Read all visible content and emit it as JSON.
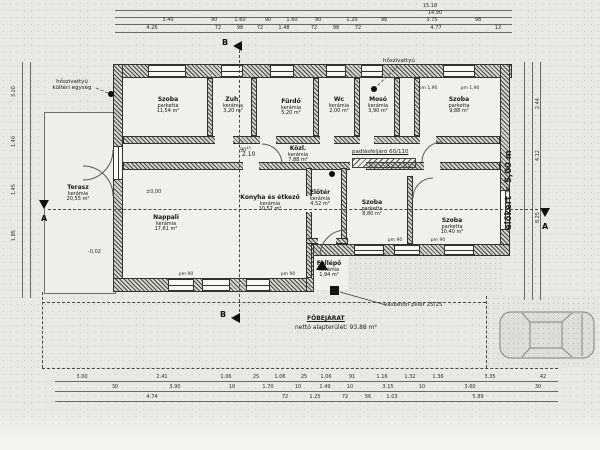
{
  "drawing": {
    "type": "floor-plan",
    "colors": {
      "paper": "#e9e8e4",
      "ink": "#34322e",
      "floor": "#f1f0ec"
    }
  },
  "labels": {
    "heat_pump_outdoor_1": "hőszivattyú",
    "heat_pump_outdoor_2": "kültéri egység",
    "heat_pump": "hőszivattyú",
    "attic_access": "padlásfeljáró 60/110",
    "door_width": "90",
    "door_width_sup": "45",
    "door_height": "2.10",
    "main_entrance": "FŐBEJÁRAT",
    "net_area": "nettó alapterület: 93,88 m²",
    "pillar": "vasbeton pillér 25/25",
    "front_yard": "előkert = 5,00 m",
    "level_zero": "±0,00",
    "level_terrace": "-0,02",
    "pm_190": "pm 1,90",
    "pm_90": "pm 90",
    "section_a": "A",
    "section_b": "B"
  },
  "rooms": [
    {
      "name": "Szoba",
      "material": "parketta",
      "area": "11,54 m²"
    },
    {
      "name": "Zuh.",
      "material": "kerámia",
      "area": "3,20 m²"
    },
    {
      "name": "Fürdő",
      "material": "kerámia",
      "area": "5,20 m²"
    },
    {
      "name": "Wc",
      "material": "kerámia",
      "area": "2,00 m²"
    },
    {
      "name": "Mosó",
      "material": "kerámia",
      "area": "3,90 m²"
    },
    {
      "name": "Szoba",
      "material": "parketta",
      "area": "9,88 m²"
    },
    {
      "name": "Terasz",
      "material": "kerámia",
      "area": "20,55 m²"
    },
    {
      "name": "Nappali",
      "material": "kerámia",
      "area": "17,61 m²"
    },
    {
      "name": "Konyha és étkező",
      "material": "kerámia",
      "area": "10,57 m²"
    },
    {
      "name": "Közl.",
      "material": "kerámia",
      "area": "7,88 m²"
    },
    {
      "name": "Előtér",
      "material": "kerámia",
      "area": "4,52 m²"
    },
    {
      "name": "Szoba",
      "material": "parketta",
      "area": "8,80 m²"
    },
    {
      "name": "Szoba",
      "material": "parketta",
      "area": "10,40 m²"
    },
    {
      "name": "Fellépő",
      "material": "kerámia",
      "area": "1,94 m²"
    }
  ],
  "dims": {
    "t1": [
      "15.18"
    ],
    "t2": [
      "14.90"
    ],
    "t3": [
      "3.40",
      "90",
      "1.60",
      "90",
      "1.60",
      "90",
      "1.20",
      "98",
      "3.75",
      "98"
    ],
    "t4": [
      "4.26",
      "72",
      "98",
      "72",
      "1.48",
      "72",
      "98",
      "72",
      "4.77",
      "12"
    ],
    "b1": [
      "3.00",
      "2.41",
      "1.06",
      "25",
      "1.06",
      "25",
      "1.06",
      "91",
      "1.16",
      "1.32",
      "1.36",
      "3.35",
      "42"
    ],
    "b2": [
      "30",
      "3.90",
      "10",
      "1.70",
      "10",
      "1.49",
      "10",
      "3.15",
      "10",
      "3.60",
      "30"
    ],
    "b3": [
      "4.74",
      "72",
      "1.25",
      "72",
      "56",
      "1.03",
      "5.89"
    ],
    "left": [
      "3.20",
      "1.40",
      "1.45",
      "1.85"
    ],
    "right": [
      "2.44",
      "4.12",
      "8.25"
    ]
  }
}
